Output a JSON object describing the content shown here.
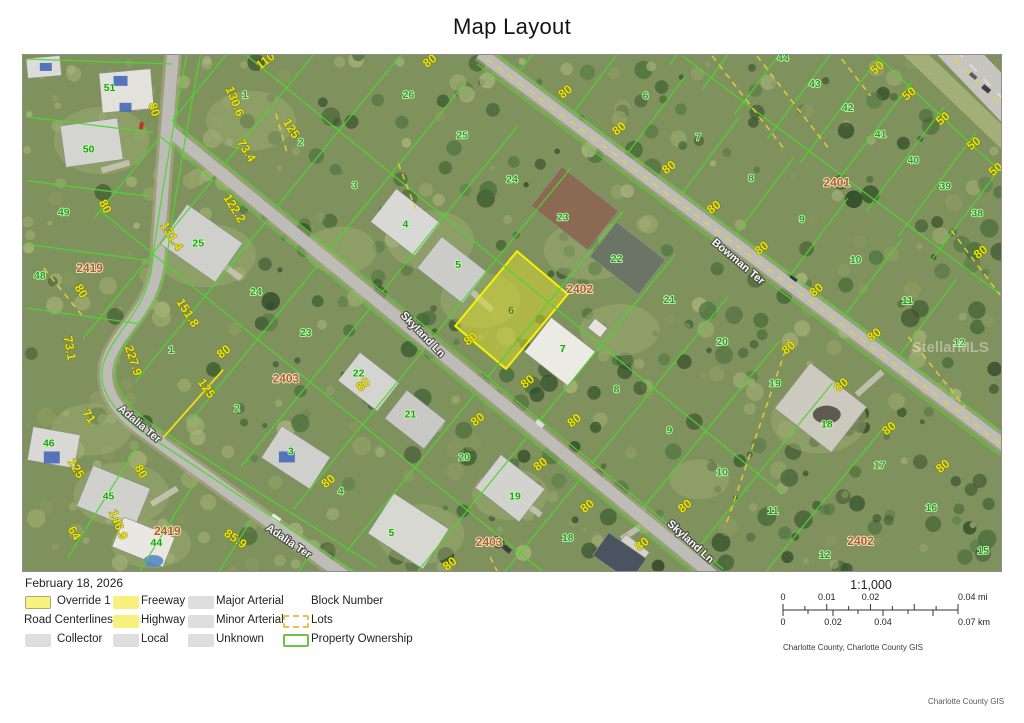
{
  "title": "Map Layout",
  "date": "February 18, 2026",
  "legend": {
    "items": [
      {
        "label": "Override 1",
        "swatch": "override"
      },
      {
        "label": "Road Centerlines",
        "swatch": "header"
      },
      {
        "label": "Collector",
        "swatch": "gray"
      },
      {
        "label": "Freeway",
        "swatch": "yellow"
      },
      {
        "label": "Highway",
        "swatch": "yellow"
      },
      {
        "label": "Local",
        "swatch": "gray"
      },
      {
        "label": "Major Arterial",
        "swatch": "gray"
      },
      {
        "label": "Minor Arterial",
        "swatch": "gray"
      },
      {
        "label": "Unknown",
        "swatch": "gray"
      },
      {
        "label": "Block Number",
        "swatch": "none"
      },
      {
        "label": "Lots",
        "swatch": "dashed"
      },
      {
        "label": "Property Ownership",
        "swatch": "green-outline"
      }
    ]
  },
  "scale": {
    "ratio": "1:1,000",
    "mi_labels": [
      "0",
      "0.01",
      "0.02",
      "0.04 mi"
    ],
    "mi_pos": [
      0,
      0.25,
      0.5,
      1
    ],
    "km_labels": [
      "0",
      "0.02",
      "0.04",
      "0.07 km"
    ],
    "km_pos": [
      0,
      0.2857,
      0.5714,
      1
    ]
  },
  "credits": {
    "attribution": "Charlotte County, Charlotte County GIS",
    "footer": "Charlotte County GIS"
  },
  "map": {
    "watermark": {
      "text": "StellarMLS",
      "x": 952,
      "y": 352
    },
    "override_label": {
      "text": "6",
      "x": 511,
      "y": 314
    },
    "street_labels": [
      {
        "t": "Skyland Ln",
        "x": 420,
        "y": 337,
        "r": 46
      },
      {
        "t": "Skyland Ln",
        "x": 689,
        "y": 545,
        "r": 42
      },
      {
        "t": "Bowman Ter",
        "x": 737,
        "y": 264,
        "r": 40
      },
      {
        "t": "Adalia Ter",
        "x": 136,
        "y": 427,
        "r": 40
      },
      {
        "t": "Adalia Ter",
        "x": 286,
        "y": 545,
        "r": 34
      }
    ],
    "block_labels": [
      {
        "t": "2419",
        "x": 88,
        "y": 272
      },
      {
        "t": "2419",
        "x": 166,
        "y": 536
      },
      {
        "t": "2403",
        "x": 285,
        "y": 383
      },
      {
        "t": "2403",
        "x": 489,
        "y": 547
      },
      {
        "t": "2402",
        "x": 580,
        "y": 293
      },
      {
        "t": "2402",
        "x": 862,
        "y": 546
      },
      {
        "t": "2401",
        "x": 838,
        "y": 186
      }
    ],
    "parcel_labels": [
      {
        "t": "51",
        "x": 108,
        "y": 90
      },
      {
        "t": "50",
        "x": 87,
        "y": 152
      },
      {
        "t": "49",
        "x": 62,
        "y": 215
      },
      {
        "t": "48",
        "x": 38,
        "y": 279
      },
      {
        "t": "46",
        "x": 47,
        "y": 447
      },
      {
        "t": "45",
        "x": 107,
        "y": 500
      },
      {
        "t": "44",
        "x": 155,
        "y": 547
      },
      {
        "t": "1",
        "x": 244,
        "y": 97
      },
      {
        "t": "2",
        "x": 300,
        "y": 145
      },
      {
        "t": "3",
        "x": 354,
        "y": 188
      },
      {
        "t": "4",
        "x": 405,
        "y": 227
      },
      {
        "t": "5",
        "x": 458,
        "y": 268
      },
      {
        "t": "7",
        "x": 563,
        "y": 352
      },
      {
        "t": "8",
        "x": 617,
        "y": 393
      },
      {
        "t": "9",
        "x": 670,
        "y": 434
      },
      {
        "t": "10",
        "x": 723,
        "y": 476
      },
      {
        "t": "11",
        "x": 774,
        "y": 515
      },
      {
        "t": "12",
        "x": 826,
        "y": 559
      },
      {
        "t": "26",
        "x": 408,
        "y": 97
      },
      {
        "t": "25",
        "x": 462,
        "y": 138
      },
      {
        "t": "24",
        "x": 512,
        "y": 182
      },
      {
        "t": "23",
        "x": 563,
        "y": 220
      },
      {
        "t": "22",
        "x": 617,
        "y": 262
      },
      {
        "t": "21",
        "x": 670,
        "y": 303
      },
      {
        "t": "20",
        "x": 723,
        "y": 345
      },
      {
        "t": "19",
        "x": 776,
        "y": 387
      },
      {
        "t": "18",
        "x": 828,
        "y": 428
      },
      {
        "t": "17",
        "x": 881,
        "y": 469
      },
      {
        "t": "16",
        "x": 933,
        "y": 512
      },
      {
        "t": "15",
        "x": 985,
        "y": 555
      },
      {
        "t": "6",
        "x": 646,
        "y": 98
      },
      {
        "t": "7",
        "x": 699,
        "y": 140
      },
      {
        "t": "8",
        "x": 752,
        "y": 181
      },
      {
        "t": "9",
        "x": 803,
        "y": 222
      },
      {
        "t": "10",
        "x": 857,
        "y": 263
      },
      {
        "t": "11",
        "x": 909,
        "y": 304
      },
      {
        "t": "12",
        "x": 961,
        "y": 346
      },
      {
        "t": "44",
        "x": 784,
        "y": 60
      },
      {
        "t": "43",
        "x": 816,
        "y": 86
      },
      {
        "t": "42",
        "x": 849,
        "y": 110
      },
      {
        "t": "41",
        "x": 882,
        "y": 137
      },
      {
        "t": "40",
        "x": 915,
        "y": 163
      },
      {
        "t": "39",
        "x": 947,
        "y": 189
      },
      {
        "t": "38",
        "x": 979,
        "y": 216
      },
      {
        "t": "25",
        "x": 197,
        "y": 246
      },
      {
        "t": "24",
        "x": 255,
        "y": 295
      },
      {
        "t": "23",
        "x": 305,
        "y": 336
      },
      {
        "t": "22",
        "x": 358,
        "y": 377
      },
      {
        "t": "21",
        "x": 410,
        "y": 418
      },
      {
        "t": "20",
        "x": 464,
        "y": 461
      },
      {
        "t": "19",
        "x": 515,
        "y": 500
      },
      {
        "t": "18",
        "x": 568,
        "y": 542
      },
      {
        "t": "1",
        "x": 170,
        "y": 353
      },
      {
        "t": "2",
        "x": 236,
        "y": 412
      },
      {
        "t": "3",
        "x": 290,
        "y": 455
      },
      {
        "t": "4",
        "x": 340,
        "y": 495
      },
      {
        "t": "5",
        "x": 391,
        "y": 537
      }
    ],
    "dim_labels": [
      {
        "t": "110",
        "x": 267,
        "y": 63,
        "r": -38
      },
      {
        "t": "80",
        "x": 432,
        "y": 63,
        "r": -38
      },
      {
        "t": "80",
        "x": 568,
        "y": 94,
        "r": -38
      },
      {
        "t": "80",
        "x": 622,
        "y": 131,
        "r": -38
      },
      {
        "t": "80",
        "x": 672,
        "y": 170,
        "r": -38
      },
      {
        "t": "50",
        "x": 881,
        "y": 70,
        "r": -38
      },
      {
        "t": "50",
        "x": 913,
        "y": 96,
        "r": -38
      },
      {
        "t": "50",
        "x": 947,
        "y": 121,
        "r": -38
      },
      {
        "t": "50",
        "x": 978,
        "y": 146,
        "r": -38
      },
      {
        "t": "50",
        "x": 1000,
        "y": 172,
        "r": -38
      },
      {
        "t": "130.6",
        "x": 230,
        "y": 102,
        "r": 68
      },
      {
        "t": "73.4",
        "x": 242,
        "y": 152,
        "r": 58
      },
      {
        "t": "125",
        "x": 287,
        "y": 130,
        "r": 58
      },
      {
        "t": "122.2",
        "x": 230,
        "y": 210,
        "r": 58
      },
      {
        "t": "131.4",
        "x": 167,
        "y": 238,
        "r": 58
      },
      {
        "t": "80",
        "x": 149,
        "y": 110,
        "r": 72
      },
      {
        "t": "80",
        "x": 100,
        "y": 208,
        "r": 62
      },
      {
        "t": "80",
        "x": 76,
        "y": 293,
        "r": 58
      },
      {
        "t": "151.8",
        "x": 183,
        "y": 315,
        "r": 58
      },
      {
        "t": "227.9",
        "x": 128,
        "y": 362,
        "r": 72
      },
      {
        "t": "73.1",
        "x": 64,
        "y": 349,
        "r": 80
      },
      {
        "t": "71",
        "x": 84,
        "y": 419,
        "r": 55
      },
      {
        "t": "125",
        "x": 202,
        "y": 391,
        "r": 55
      },
      {
        "t": "125",
        "x": 71,
        "y": 471,
        "r": 60
      },
      {
        "t": "146.9",
        "x": 113,
        "y": 527,
        "r": 68
      },
      {
        "t": "64",
        "x": 69,
        "y": 536,
        "r": 60
      },
      {
        "t": "85.9",
        "x": 232,
        "y": 543,
        "r": 35
      },
      {
        "t": "80",
        "x": 225,
        "y": 355,
        "r": -38
      },
      {
        "t": "80",
        "x": 330,
        "y": 485,
        "r": -38
      },
      {
        "t": "80",
        "x": 136,
        "y": 474,
        "r": 60
      },
      {
        "t": "80",
        "x": 473,
        "y": 342,
        "r": -38
      },
      {
        "t": "80",
        "x": 530,
        "y": 385,
        "r": -38
      },
      {
        "t": "80",
        "x": 365,
        "y": 388,
        "r": -38
      },
      {
        "t": "80",
        "x": 480,
        "y": 423,
        "r": -38
      },
      {
        "t": "80",
        "x": 543,
        "y": 468,
        "r": -38
      },
      {
        "t": "80",
        "x": 577,
        "y": 424,
        "r": -38
      },
      {
        "t": "80",
        "x": 452,
        "y": 568,
        "r": -38
      },
      {
        "t": "80",
        "x": 590,
        "y": 510,
        "r": -38
      },
      {
        "t": "80",
        "x": 688,
        "y": 510,
        "r": -38
      },
      {
        "t": "80",
        "x": 645,
        "y": 548,
        "r": -38
      },
      {
        "t": "80",
        "x": 717,
        "y": 210,
        "r": -38
      },
      {
        "t": "80",
        "x": 765,
        "y": 251,
        "r": -38
      },
      {
        "t": "80",
        "x": 820,
        "y": 293,
        "r": -38
      },
      {
        "t": "80",
        "x": 878,
        "y": 338,
        "r": -38
      },
      {
        "t": "80",
        "x": 792,
        "y": 351,
        "r": -38
      },
      {
        "t": "80",
        "x": 893,
        "y": 432,
        "r": -38
      },
      {
        "t": "80",
        "x": 947,
        "y": 470,
        "r": -38
      },
      {
        "t": "80",
        "x": 985,
        "y": 255,
        "r": -38
      },
      {
        "t": "80",
        "x": 845,
        "y": 388,
        "r": -38
      }
    ],
    "colors": {
      "parcel_line": "#4ed630",
      "dim_text": "#f0e70a",
      "parcel_text": "#1ba313",
      "block_text": "#a8622a",
      "street_text": "#fcfcf8",
      "override_fill": "#d6d633",
      "override_stroke": "#f4f400",
      "lot_dash": "#e8c93e"
    }
  }
}
